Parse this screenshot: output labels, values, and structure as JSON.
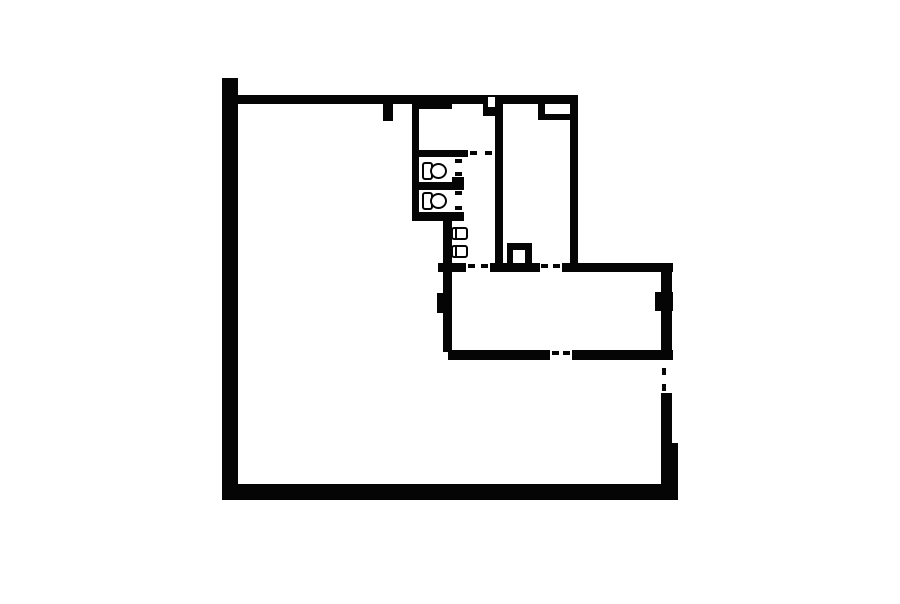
{
  "canvas": {
    "width": 900,
    "height": 604,
    "background": "#ffffff"
  },
  "floorplan": {
    "wall_color": "#050505",
    "label": {
      "text": "f",
      "color": "#8f8f8f",
      "x": 225,
      "y": 419,
      "font_size": 17
    },
    "walls": [
      {
        "name": "left-outer-wall",
        "x": 222,
        "y": 78,
        "w": 16,
        "h": 422
      },
      {
        "name": "top-outer-wall",
        "x": 222,
        "y": 95,
        "w": 356,
        "h": 9
      },
      {
        "name": "top-wall-thick-segment",
        "x": 412,
        "y": 95,
        "w": 40,
        "h": 14
      },
      {
        "name": "top-wall-stub",
        "x": 383,
        "y": 104,
        "w": 10,
        "h": 17
      },
      {
        "name": "toilet-block-left-wall",
        "x": 412,
        "y": 104,
        "w": 7,
        "h": 117
      },
      {
        "name": "toproom-bottom-wall",
        "x": 412,
        "y": 150,
        "w": 56,
        "h": 7
      },
      {
        "name": "corridor-right-wall",
        "x": 495,
        "y": 104,
        "w": 8,
        "h": 168
      },
      {
        "name": "vent-stub",
        "x": 483,
        "y": 104,
        "w": 12,
        "h": 12
      },
      {
        "name": "niche-block",
        "x": 538,
        "y": 104,
        "w": 40,
        "h": 16
      },
      {
        "name": "upper-right-wall",
        "x": 570,
        "y": 95,
        "w": 8,
        "h": 168
      },
      {
        "name": "stall-divider-wall",
        "x": 412,
        "y": 182,
        "w": 42,
        "h": 8
      },
      {
        "name": "stall-divider-end-block",
        "x": 452,
        "y": 177,
        "w": 12,
        "h": 13
      },
      {
        "name": "stall-bottom-wall",
        "x": 412,
        "y": 212,
        "w": 52,
        "h": 9
      },
      {
        "name": "washroom-left-wall",
        "x": 443,
        "y": 221,
        "w": 9,
        "h": 131
      },
      {
        "name": "mid-wall-segment-a",
        "x": 438,
        "y": 263,
        "w": 28,
        "h": 9
      },
      {
        "name": "mid-wall-segment-b",
        "x": 490,
        "y": 263,
        "w": 50,
        "h": 9
      },
      {
        "name": "mid-wall-segment-c",
        "x": 562,
        "y": 263,
        "w": 111,
        "h": 9
      },
      {
        "name": "duct-column",
        "x": 507,
        "y": 243,
        "w": 25,
        "h": 20
      },
      {
        "name": "left-pilaster",
        "x": 437,
        "y": 293,
        "w": 15,
        "h": 20
      },
      {
        "name": "middleroom-right-wall",
        "x": 661,
        "y": 263,
        "w": 11,
        "h": 95
      },
      {
        "name": "right-pilaster",
        "x": 655,
        "y": 292,
        "w": 18,
        "h": 19
      },
      {
        "name": "middleroom-bottom-wall-a",
        "x": 448,
        "y": 350,
        "w": 102,
        "h": 10
      },
      {
        "name": "middleroom-bottom-wall-b",
        "x": 572,
        "y": 350,
        "w": 101,
        "h": 10
      },
      {
        "name": "lower-right-wall-upper",
        "x": 661,
        "y": 393,
        "w": 11,
        "h": 50
      },
      {
        "name": "lower-right-wall-lower",
        "x": 661,
        "y": 443,
        "w": 17,
        "h": 41
      },
      {
        "name": "bottom-outer-wall",
        "x": 222,
        "y": 484,
        "w": 456,
        "h": 16
      }
    ],
    "cutouts": [
      {
        "name": "vent-notch",
        "x": 488,
        "y": 97,
        "w": 7,
        "h": 10
      },
      {
        "name": "niche-interior",
        "x": 545,
        "y": 104,
        "w": 25,
        "h": 10
      },
      {
        "name": "duct-column-interior",
        "x": 513,
        "y": 250,
        "w": 12,
        "h": 13
      }
    ],
    "door_ticks": [
      {
        "name": "toproom-door-tick-left",
        "x": 470,
        "y": 151,
        "w": 7,
        "h": 4
      },
      {
        "name": "toproom-door-tick-right",
        "x": 485,
        "y": 151,
        "w": 7,
        "h": 4
      },
      {
        "name": "stall1-door-tick-top",
        "x": 455,
        "y": 159,
        "w": 7,
        "h": 4
      },
      {
        "name": "stall1-door-tick-bottom",
        "x": 455,
        "y": 172,
        "w": 7,
        "h": 4
      },
      {
        "name": "stall2-door-tick-top",
        "x": 455,
        "y": 191,
        "w": 7,
        "h": 4
      },
      {
        "name": "stall2-door-tick-bottom",
        "x": 455,
        "y": 206,
        "w": 7,
        "h": 4
      },
      {
        "name": "corridor-door-tick-left",
        "x": 468,
        "y": 264,
        "w": 7,
        "h": 4
      },
      {
        "name": "corridor-door-tick-right",
        "x": 481,
        "y": 264,
        "w": 7,
        "h": 4
      },
      {
        "name": "rightroom-door-tick-left",
        "x": 541,
        "y": 264,
        "w": 7,
        "h": 4
      },
      {
        "name": "rightroom-door-tick-right",
        "x": 553,
        "y": 264,
        "w": 7,
        "h": 4
      },
      {
        "name": "middleroom-door-tick-left",
        "x": 552,
        "y": 351,
        "w": 7,
        "h": 4
      },
      {
        "name": "middleroom-door-tick-right",
        "x": 563,
        "y": 351,
        "w": 7,
        "h": 4
      },
      {
        "name": "right-opening-tick-top",
        "x": 662,
        "y": 368,
        "w": 4,
        "h": 7
      },
      {
        "name": "right-opening-tick-bottom",
        "x": 662,
        "y": 384,
        "w": 4,
        "h": 7
      }
    ],
    "toilets": [
      {
        "name": "toilet-stall-1",
        "x": 422,
        "y": 162
      },
      {
        "name": "toilet-stall-2",
        "x": 422,
        "y": 192
      }
    ],
    "sinks": [
      {
        "name": "sink-1",
        "x": 451,
        "y": 227
      },
      {
        "name": "sink-2",
        "x": 451,
        "y": 245
      }
    ]
  }
}
